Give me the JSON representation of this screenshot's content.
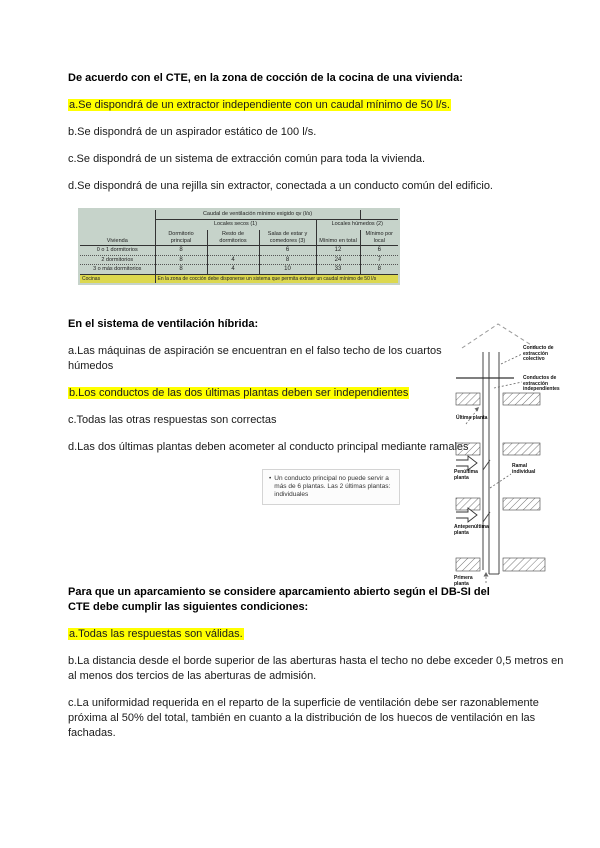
{
  "page": {
    "background": "#ffffff",
    "highlight_color": "#ffff00",
    "table_bg_color": "#c6d3ca",
    "table_note_color": "#dcd84f"
  },
  "questions": [
    {
      "title": "De acuerdo con el CTE, en la zona de cocción de la cocina de una vivienda:",
      "options": [
        {
          "text": "a.Se dispondrá de un extractor independiente con un caudal mínimo de 50 l/s.",
          "highlighted": true
        },
        {
          "text": "b.Se dispondrá de un aspirador estático de 100 l/s.",
          "highlighted": false
        },
        {
          "text": "c.Se dispondrá de un sistema de extracción común para toda la vivienda.",
          "highlighted": false
        },
        {
          "text": "d.Se dispondrá de una rejilla sin extractor, conectada a un conducto común del edificio.",
          "highlighted": false
        }
      ]
    },
    {
      "title": " En el sistema de ventilación híbrida:",
      "options": [
        {
          "text": "a.Las máquinas de aspiración se encuentran en el falso techo de los cuartos húmedos",
          "highlighted": false
        },
        {
          "text": "b.Los conductos de las dos últimas plantas deben ser independientes",
          "highlighted": true
        },
        {
          "text": "c.Todas las otras respuestas son correctas",
          "highlighted": false
        },
        {
          "text": "d.Las dos últimas plantas deben acometer al conducto principal mediante ramales",
          "highlighted": false
        }
      ]
    },
    {
      "title": "Para que un aparcamiento se considere aparcamiento abierto según el DB-SI del CTE debe cumplir las siguientes condiciones:",
      "options": [
        {
          "text": "a.Todas las respuestas son válidas.",
          "highlighted": true
        },
        {
          "text": "b.La distancia desde el borde superior de las aberturas hasta el techo no debe exceder 0,5 metros en al menos dos tercios de las aberturas de admisión.",
          "highlighted": false
        },
        {
          "text": "c.La uniformidad requerida en el reparto de la superficie de ventilación debe ser razonablemente próxima al 50% del total, también en cuanto a la distribución de los huecos de ventilación en las fachadas.",
          "highlighted": false
        }
      ]
    }
  ],
  "table": {
    "title": "Caudal de ventilación mínimo exigido qv (l/s)",
    "group_secos": "Locales secos (1)",
    "group_humedos": "Locales húmedos (2)",
    "row_header": "Vivienda",
    "col_headers": [
      "Dormitorio principal",
      "Resto de dormitorios",
      "Salas de estar y comedores (3)",
      "Mínimo en total",
      "Mínimo por local"
    ],
    "rows": [
      {
        "label": "0 o 1 dormitorios",
        "values": [
          "8",
          "",
          "6",
          "12",
          "6"
        ]
      },
      {
        "label": "2 dormitorios",
        "values": [
          "8",
          "4",
          "8",
          "24",
          "7"
        ]
      },
      {
        "label": "3 o más dormitorios",
        "values": [
          "8",
          "4",
          "10",
          "33",
          "8"
        ]
      }
    ],
    "note": {
      "label": "Cocinas",
      "text": "En la zona de cocción debe disponerse un sistema que permita extraer un caudal mínimo de 50 l/s"
    }
  },
  "callout": {
    "bullet": "•",
    "text": "Un conducto principal no puede servir a más de 6 plantas. Las 2 últimas plantas: individuales"
  },
  "diagram": {
    "label_conducto_colectivo": "Conducto de extracción colectivo",
    "label_conductos_independientes": "Conductos de extracción independientes",
    "label_ramal": "Ramal individual",
    "label_ultima": "Última planta",
    "label_penultima": "Penúltima planta",
    "label_antepenultima": "Antepenúltima planta",
    "label_primera": "Primera planta"
  }
}
